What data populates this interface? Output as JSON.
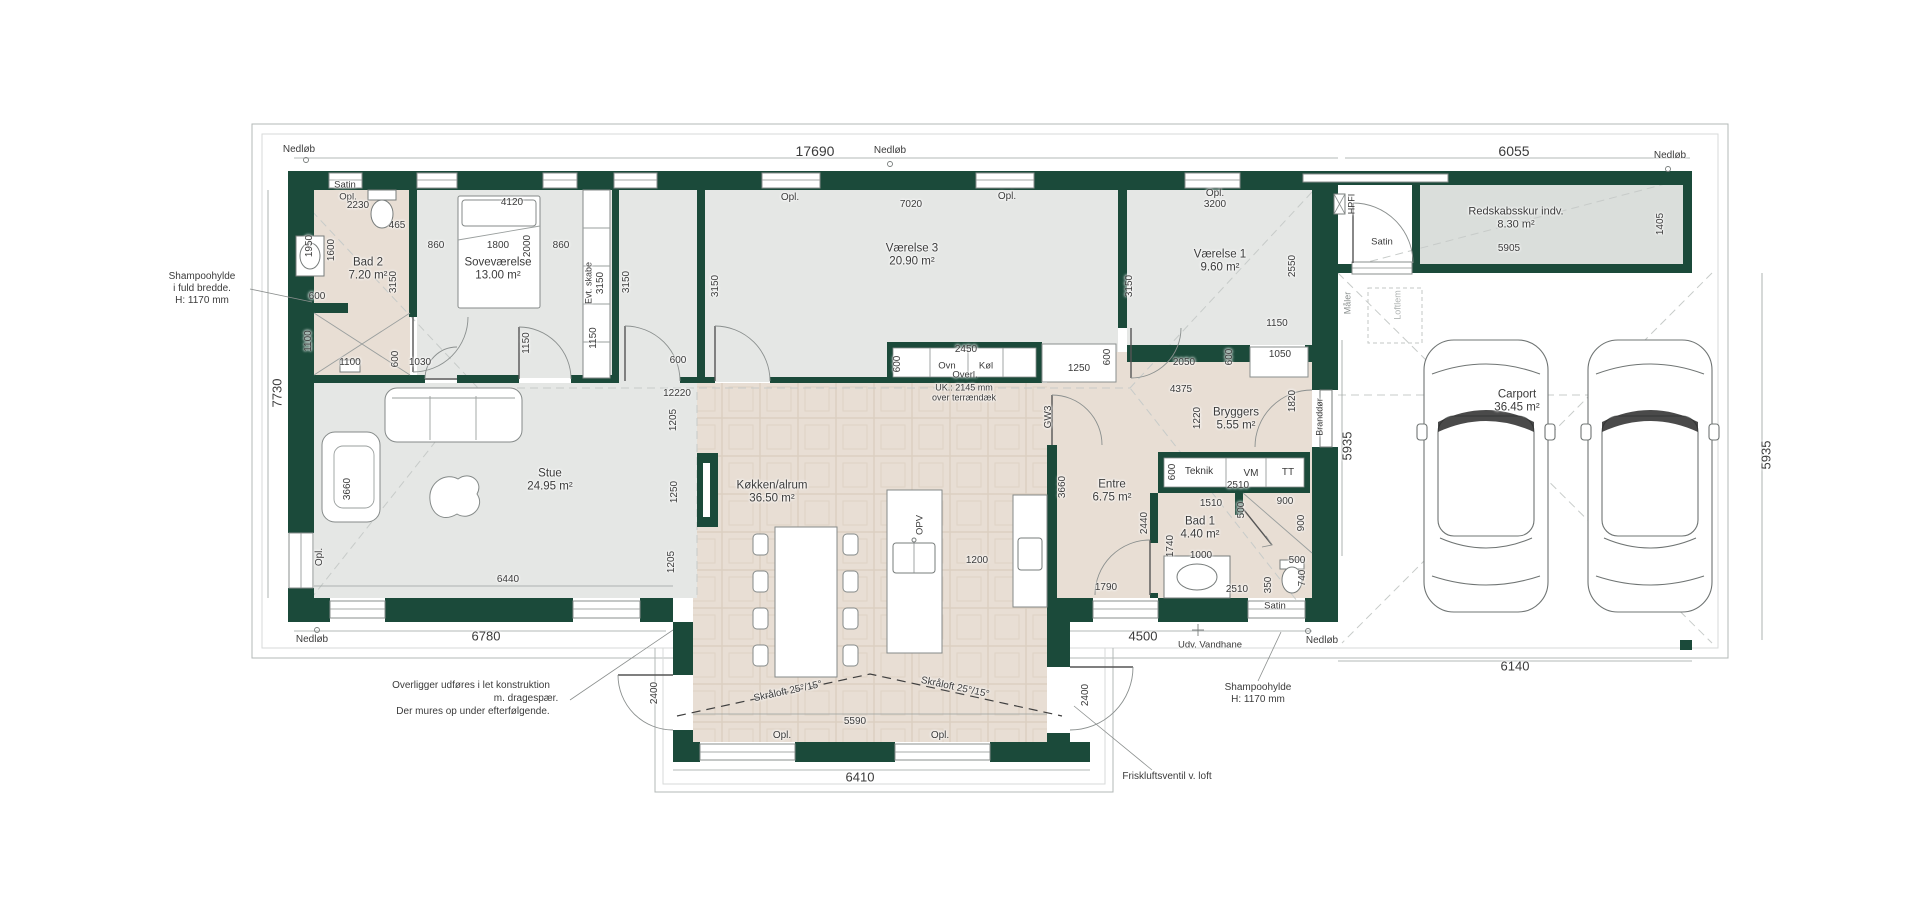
{
  "meta": {
    "type": "architectural-floor-plan",
    "width": 1920,
    "height": 920
  },
  "colors": {
    "wall": "#1b4a3a",
    "floor_warm": "#e8ded4",
    "floor_cool": "#e5e7e5",
    "floor_shed": "#dadedb",
    "tile_line": "#d2c4b6",
    "outline": "#b3b8b7",
    "dash": "#c7cbc9",
    "text": "#3b3b3b"
  },
  "rooms": [
    {
      "name": "Bad 2",
      "area": "7.20 m²"
    },
    {
      "name": "Soveværelse",
      "area": "13.00 m²"
    },
    {
      "name": "Værelse 3",
      "area": "20.90 m²"
    },
    {
      "name": "Værelse 1",
      "area": "9.60 m²"
    },
    {
      "name": "Stue",
      "area": "24.95 m²"
    },
    {
      "name": "Køkken/alrum",
      "area": "36.50 m²"
    },
    {
      "name": "Entre",
      "area": "6.75 m²"
    },
    {
      "name": "Bryggers",
      "area": "5.55 m²"
    },
    {
      "name": "Bad 1",
      "area": "4.40 m²"
    },
    {
      "name": "Redskabsskur indv.",
      "area": "8.30 m²"
    },
    {
      "name": "Carport",
      "area": "36.45 m²"
    }
  ],
  "labels": [
    {
      "t": "Nedløb",
      "x": 299,
      "y": 150,
      "s": 10
    },
    {
      "t": "17690",
      "x": 815,
      "y": 151,
      "s": 14
    },
    {
      "t": "Nedløb",
      "x": 890,
      "y": 151,
      "s": 10
    },
    {
      "t": "6055",
      "x": 1514,
      "y": 151,
      "s": 14
    },
    {
      "t": "Nedløb",
      "x": 1670,
      "y": 156,
      "s": 10
    },
    {
      "t": "Satin",
      "x": 345,
      "y": 185,
      "s": 9.5
    },
    {
      "t": "Opl.",
      "x": 348,
      "y": 197,
      "s": 9.5
    },
    {
      "t": "2230",
      "x": 358,
      "y": 206,
      "s": 10
    },
    {
      "t": "465",
      "x": 397,
      "y": 226,
      "s": 10
    },
    {
      "t": "1950",
      "x": 310,
      "y": 246,
      "r": -90,
      "s": 10
    },
    {
      "t": "1600",
      "x": 332,
      "y": 250,
      "r": -90,
      "s": 10
    },
    {
      "t": "Bad 2",
      "x": 368,
      "y": 263,
      "s": 11.5
    },
    {
      "t": "7.20 m²",
      "x": 368,
      "y": 276,
      "s": 11.5
    },
    {
      "t": "3150",
      "x": 394,
      "y": 282,
      "r": -90,
      "s": 10
    },
    {
      "t": "860",
      "x": 436,
      "y": 246,
      "s": 10
    },
    {
      "t": "1800",
      "x": 498,
      "y": 246,
      "s": 10
    },
    {
      "t": "2000",
      "x": 528,
      "y": 246,
      "r": -90,
      "s": 10
    },
    {
      "t": "860",
      "x": 561,
      "y": 246,
      "s": 10
    },
    {
      "t": "4120",
      "x": 512,
      "y": 203,
      "s": 10
    },
    {
      "t": "Soveværelse",
      "x": 498,
      "y": 263,
      "s": 11.5
    },
    {
      "t": "13.00 m²",
      "x": 498,
      "y": 276,
      "s": 11.5
    },
    {
      "t": "600",
      "x": 317,
      "y": 297,
      "s": 10
    },
    {
      "t": "1100",
      "x": 309,
      "y": 341,
      "r": -90,
      "s": 10
    },
    {
      "t": "1100",
      "x": 350,
      "y": 363,
      "s": 10
    },
    {
      "t": "600",
      "x": 396,
      "y": 359,
      "r": -90,
      "s": 10
    },
    {
      "t": "1030",
      "x": 420,
      "y": 363,
      "s": 10
    },
    {
      "t": "Evt. skabe",
      "x": 589,
      "y": 283,
      "r": -90,
      "s": 9
    },
    {
      "t": "3150",
      "x": 601,
      "y": 283,
      "r": -90,
      "s": 10
    },
    {
      "t": "3150",
      "x": 627,
      "y": 282,
      "r": -90,
      "s": 10
    },
    {
      "t": "1150",
      "x": 527,
      "y": 343,
      "r": -90,
      "s": 10
    },
    {
      "t": "1150",
      "x": 594,
      "y": 338,
      "r": -90,
      "s": 10
    },
    {
      "t": "600",
      "x": 678,
      "y": 361,
      "s": 10
    },
    {
      "t": "Opl.",
      "x": 790,
      "y": 198,
      "s": 10
    },
    {
      "t": "7020",
      "x": 911,
      "y": 205,
      "s": 10
    },
    {
      "t": "Værelse 3",
      "x": 912,
      "y": 249,
      "s": 11.5
    },
    {
      "t": "20.90 m²",
      "x": 912,
      "y": 262,
      "s": 11.5
    },
    {
      "t": "3150",
      "x": 716,
      "y": 286,
      "r": -90,
      "s": 10
    },
    {
      "t": "Opl.",
      "x": 1007,
      "y": 197,
      "s": 10
    },
    {
      "t": "Opl.",
      "x": 1215,
      "y": 194,
      "s": 10
    },
    {
      "t": "3200",
      "x": 1215,
      "y": 205,
      "s": 10
    },
    {
      "t": "Værelse 1",
      "x": 1220,
      "y": 255,
      "s": 11.5
    },
    {
      "t": "9.60 m²",
      "x": 1220,
      "y": 268,
      "s": 11.5
    },
    {
      "t": "3150",
      "x": 1130,
      "y": 286,
      "r": -90,
      "s": 10
    },
    {
      "t": "2550",
      "x": 1293,
      "y": 266,
      "r": -90,
      "s": 10
    },
    {
      "t": "1150",
      "x": 1277,
      "y": 324,
      "s": 10
    },
    {
      "t": "600",
      "x": 1230,
      "y": 357,
      "r": -90,
      "s": 10
    },
    {
      "t": "1050",
      "x": 1280,
      "y": 355,
      "s": 10
    },
    {
      "t": "2050",
      "x": 1184,
      "y": 363,
      "s": 10
    },
    {
      "t": "2450",
      "x": 966,
      "y": 350,
      "s": 10
    },
    {
      "t": "600",
      "x": 898,
      "y": 364,
      "r": -90,
      "s": 10
    },
    {
      "t": "Ovn",
      "x": 947,
      "y": 366,
      "s": 9.5
    },
    {
      "t": "Køl",
      "x": 986,
      "y": 366,
      "s": 9.5
    },
    {
      "t": "Overl.",
      "x": 965,
      "y": 375,
      "s": 9.5
    },
    {
      "t": "UK.: 2145 mm",
      "x": 964,
      "y": 388,
      "s": 9
    },
    {
      "t": "over terrændæk",
      "x": 964,
      "y": 398,
      "s": 9
    },
    {
      "t": "1250",
      "x": 1079,
      "y": 369,
      "s": 10
    },
    {
      "t": "600",
      "x": 1108,
      "y": 357,
      "r": -90,
      "s": 10
    },
    {
      "t": "GW3",
      "x": 1049,
      "y": 417,
      "r": -90,
      "s": 10
    },
    {
      "t": "12220",
      "x": 677,
      "y": 394,
      "s": 10
    },
    {
      "t": "1205",
      "x": 674,
      "y": 420,
      "r": -90,
      "s": 10
    },
    {
      "t": "1250",
      "x": 675,
      "y": 492,
      "r": -90,
      "s": 10
    },
    {
      "t": "1205",
      "x": 672,
      "y": 562,
      "r": -90,
      "s": 10
    },
    {
      "t": "Stue",
      "x": 550,
      "y": 474,
      "s": 11.5
    },
    {
      "t": "24.95 m²",
      "x": 550,
      "y": 487,
      "s": 11.5
    },
    {
      "t": "3660",
      "x": 348,
      "y": 489,
      "r": -90,
      "s": 10
    },
    {
      "t": "7730",
      "x": 277,
      "y": 393,
      "r": -90,
      "s": 13
    },
    {
      "t": "Opl.",
      "x": 320,
      "y": 557,
      "r": -90,
      "s": 10
    },
    {
      "t": "6440",
      "x": 508,
      "y": 580,
      "s": 10
    },
    {
      "t": "Nedløb",
      "x": 312,
      "y": 640,
      "s": 10
    },
    {
      "t": "6780",
      "x": 486,
      "y": 636,
      "s": 13
    },
    {
      "t": "Køkken/alrum",
      "x": 772,
      "y": 486,
      "s": 11.5
    },
    {
      "t": "36.50 m²",
      "x": 772,
      "y": 499,
      "s": 11.5
    },
    {
      "t": "OPV",
      "x": 920,
      "y": 525,
      "r": -90,
      "s": 9.5
    },
    {
      "t": "1200",
      "x": 977,
      "y": 561,
      "s": 10
    },
    {
      "t": "Entre",
      "x": 1112,
      "y": 485,
      "s": 11.5
    },
    {
      "t": "6.75 m²",
      "x": 1112,
      "y": 498,
      "s": 11.5
    },
    {
      "t": "3660",
      "x": 1063,
      "y": 487,
      "r": -90,
      "s": 10
    },
    {
      "t": "2440",
      "x": 1145,
      "y": 523,
      "r": -90,
      "s": 10
    },
    {
      "t": "4375",
      "x": 1181,
      "y": 390,
      "s": 10
    },
    {
      "t": "1220",
      "x": 1198,
      "y": 418,
      "r": -90,
      "s": 10
    },
    {
      "t": "Bryggers",
      "x": 1236,
      "y": 413,
      "s": 11.5
    },
    {
      "t": "5.55 m²",
      "x": 1236,
      "y": 426,
      "s": 11.5
    },
    {
      "t": "1820",
      "x": 1293,
      "y": 401,
      "r": -90,
      "s": 10
    },
    {
      "t": "Branddør",
      "x": 1320,
      "y": 417,
      "r": -90,
      "s": 9
    },
    {
      "t": "5935",
      "x": 1347,
      "y": 446,
      "r": -90,
      "s": 13
    },
    {
      "t": "Teknik",
      "x": 1199,
      "y": 472,
      "s": 10
    },
    {
      "t": "VM",
      "x": 1251,
      "y": 474,
      "s": 10
    },
    {
      "t": "TT",
      "x": 1288,
      "y": 473,
      "s": 10
    },
    {
      "t": "600",
      "x": 1173,
      "y": 472,
      "r": -90,
      "s": 10
    },
    {
      "t": "2510",
      "x": 1238,
      "y": 486,
      "s": 10
    },
    {
      "t": "1510",
      "x": 1211,
      "y": 504,
      "s": 10
    },
    {
      "t": "500",
      "x": 1242,
      "y": 510,
      "r": -90,
      "s": 10
    },
    {
      "t": "900",
      "x": 1285,
      "y": 502,
      "s": 10
    },
    {
      "t": "900",
      "x": 1302,
      "y": 523,
      "r": -90,
      "s": 10
    },
    {
      "t": "Bad 1",
      "x": 1200,
      "y": 522,
      "s": 11.5
    },
    {
      "t": "4.40 m²",
      "x": 1200,
      "y": 535,
      "s": 11.5
    },
    {
      "t": "1740",
      "x": 1171,
      "y": 546,
      "r": -90,
      "s": 10
    },
    {
      "t": "1000",
      "x": 1201,
      "y": 556,
      "s": 10
    },
    {
      "t": "500",
      "x": 1297,
      "y": 561,
      "s": 10
    },
    {
      "t": "740",
      "x": 1303,
      "y": 578,
      "r": -90,
      "s": 10
    },
    {
      "t": "350",
      "x": 1269,
      "y": 585,
      "r": -90,
      "s": 10
    },
    {
      "t": "2510",
      "x": 1237,
      "y": 590,
      "s": 10
    },
    {
      "t": "1790",
      "x": 1106,
      "y": 588,
      "s": 10
    },
    {
      "t": "4500",
      "x": 1143,
      "y": 636,
      "s": 13
    },
    {
      "t": "Udv. Vandhane",
      "x": 1210,
      "y": 645,
      "s": 9.5
    },
    {
      "t": "Satin",
      "x": 1275,
      "y": 606,
      "s": 9.5
    },
    {
      "t": "Nedløb",
      "x": 1322,
      "y": 641,
      "s": 10
    },
    {
      "t": "2400",
      "x": 655,
      "y": 693,
      "r": -90,
      "s": 10
    },
    {
      "t": "2400",
      "x": 1086,
      "y": 695,
      "r": -90,
      "s": 10
    },
    {
      "t": "Skråloft 25°/15°",
      "x": 788,
      "y": 692,
      "r": -12,
      "s": 10
    },
    {
      "t": "Skråloft 25°/15°",
      "x": 955,
      "y": 688,
      "r": 12,
      "s": 10
    },
    {
      "t": "5590",
      "x": 855,
      "y": 722,
      "s": 10
    },
    {
      "t": "Opl.",
      "x": 782,
      "y": 736,
      "s": 10
    },
    {
      "t": "Opl.",
      "x": 940,
      "y": 736,
      "s": 10
    },
    {
      "t": "6410",
      "x": 860,
      "y": 777,
      "s": 13
    },
    {
      "t": "Overligger udføres i let konstruktion",
      "x": 471,
      "y": 686,
      "s": 10
    },
    {
      "t": "m. dragespær.",
      "x": 526,
      "y": 699,
      "s": 10
    },
    {
      "t": "Der mures op under efterfølgende.",
      "x": 473,
      "y": 712,
      "s": 10
    },
    {
      "t": "Shampoohylde",
      "x": 202,
      "y": 277,
      "s": 10
    },
    {
      "t": "i fuld bredde.",
      "x": 202,
      "y": 289,
      "s": 10
    },
    {
      "t": "H: 1170 mm",
      "x": 202,
      "y": 301,
      "s": 10
    },
    {
      "t": "Shampoohylde",
      "x": 1258,
      "y": 688,
      "s": 10
    },
    {
      "t": "H: 1170 mm",
      "x": 1258,
      "y": 700,
      "s": 10
    },
    {
      "t": "Friskluftsventil v. loft",
      "x": 1167,
      "y": 777,
      "s": 10
    },
    {
      "t": "Carport",
      "x": 1517,
      "y": 395,
      "s": 11.5
    },
    {
      "t": "36.45 m²",
      "x": 1517,
      "y": 408,
      "s": 11.5
    },
    {
      "t": "6140",
      "x": 1515,
      "y": 666,
      "s": 13
    },
    {
      "t": "5935",
      "x": 1766,
      "y": 455,
      "r": -90,
      "s": 13
    },
    {
      "t": "Redskabsskur indv.",
      "x": 1516,
      "y": 212,
      "s": 11
    },
    {
      "t": "8.30 m²",
      "x": 1516,
      "y": 225,
      "s": 11
    },
    {
      "t": "5905",
      "x": 1509,
      "y": 249,
      "s": 10
    },
    {
      "t": "1405",
      "x": 1661,
      "y": 224,
      "r": -90,
      "s": 10
    },
    {
      "t": "HPFI",
      "x": 1352,
      "y": 204,
      "r": -90,
      "s": 9
    },
    {
      "t": "Satin",
      "x": 1382,
      "y": 242,
      "s": 9.5
    },
    {
      "t": "Måler",
      "x": 1348,
      "y": 303,
      "r": -90,
      "s": 9,
      "c": "#8a8f8e"
    },
    {
      "t": "Loftlem",
      "x": 1398,
      "y": 305,
      "r": -90,
      "s": 9,
      "c": "#b2b6b5"
    }
  ]
}
